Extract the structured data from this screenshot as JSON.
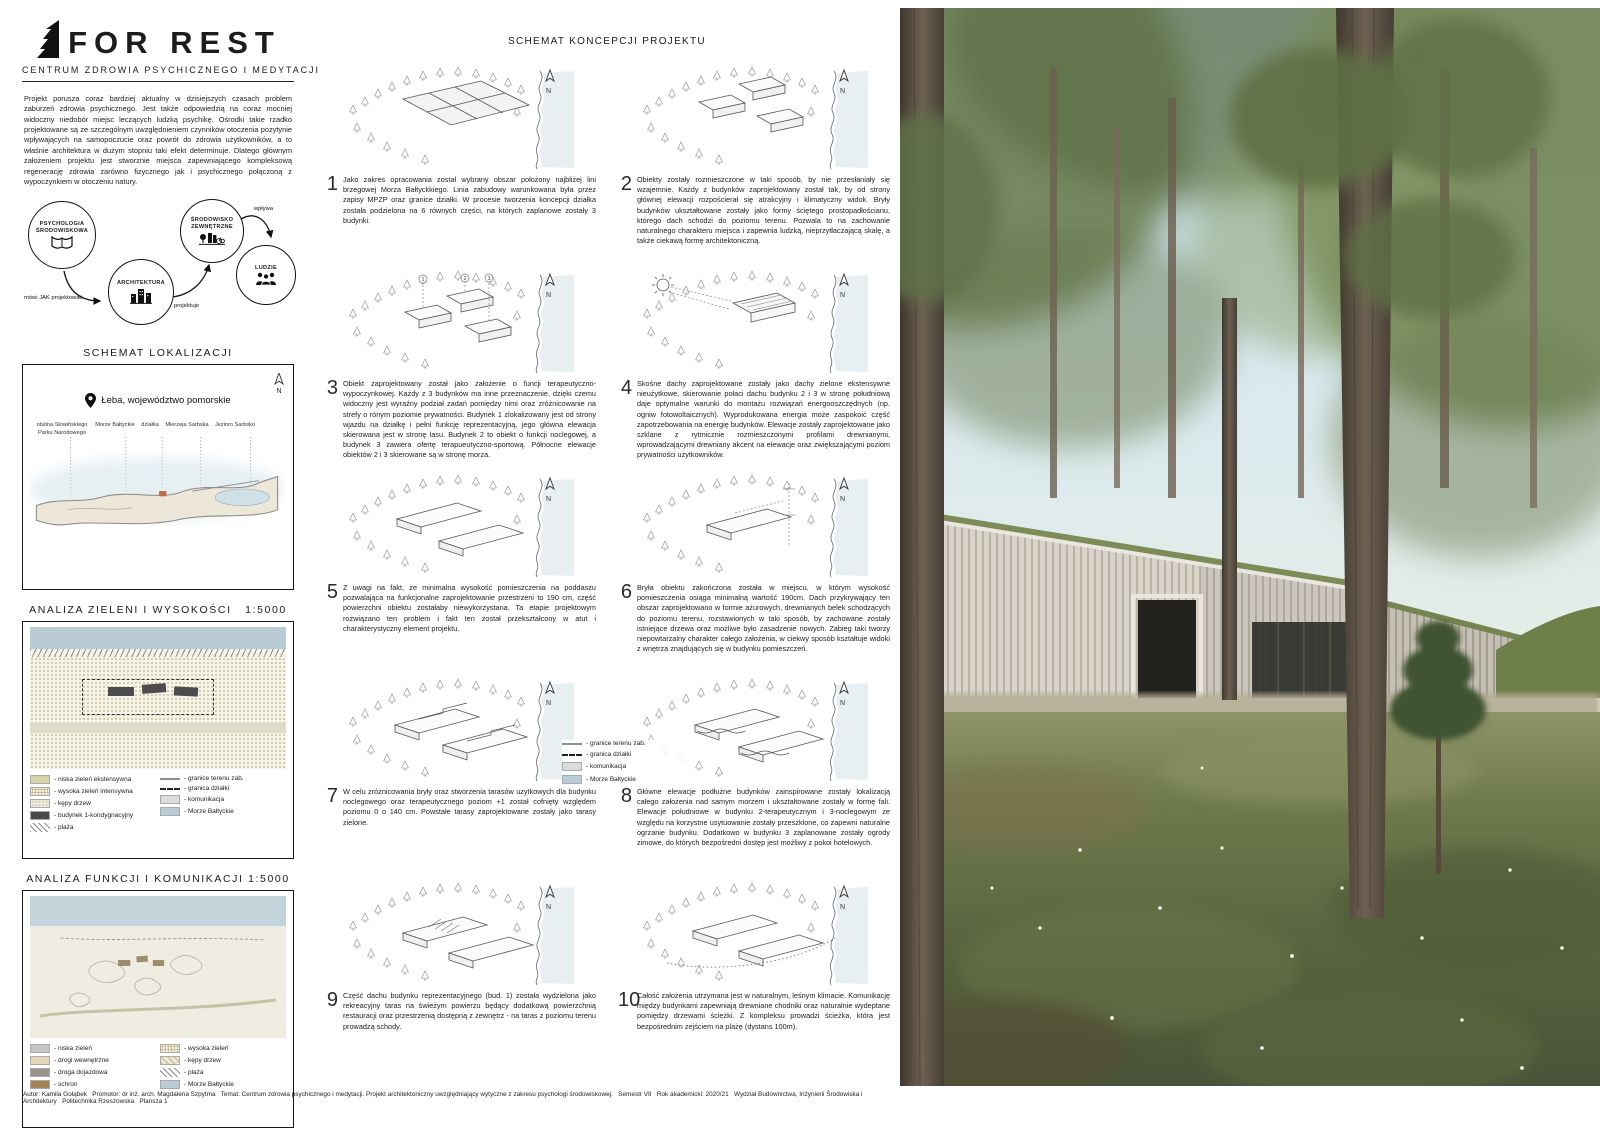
{
  "north": "N",
  "header": {
    "title": "FOR REST",
    "subtitle": "CENTRUM ZDROWIA PSYCHICZNEGO I MEDYTACJI"
  },
  "intro": "Projekt porusza coraz bardziej aktualny w dzisiejszych czasach problem zaburzeń zdrowia psychicznego. Jest także odpowiedzią na coraz mocniej widoczny niedobór miejsc leczących ludzką psychikę. Ośrodki takie rzadko projektowane są ze szczególnym uwzględnieniem czynników otoczenia pozytynie wpływających na samopoczucie oraz powrót do zdrowia użytkowników, a to właśnie architektura w dużym stopniu taki efekt determinuje. Dlatego głównym założeniem projektu jest stworznie miejsca zapewniającego kompleksową regenerację zdrowia zarówno fizycznego jak i psychicznego połączoną z wypoczynkiem w otoczeniu natury.",
  "flow": {
    "circle1": "PSYCHOLOGIA ŚRODOWISKOWA",
    "circle2": "ARCHITEKTURA",
    "circle3": "ŚRODOWISKO ZEWNĘTRZNE",
    "circle4": "LUDZIE",
    "arrow1": "mówi JAK projektować",
    "arrow2": "projektuje",
    "arrow3": "wpływa"
  },
  "localization": {
    "title": "SCHEMAT LOKALIZACJI",
    "place": "Łeba, województwo pomorskie",
    "labels": [
      "otulina Słowińskiego Parku Narodowego",
      "Morze Bałtyckie",
      "działka",
      "Mierzeja Sarbska",
      "Jezioro Sarbsko"
    ]
  },
  "analysis_green": {
    "title": "ANALIZA ZIELENI I WYSOKOŚCI   1:5000",
    "legend": [
      "- niska zieleń ekstensywna",
      "- wysoka zieleń intensywna",
      "- kępy drzew",
      "- budynek 1-kondygnacyjny",
      "- plaża",
      "- granice terenu zab.",
      "- granica działki",
      "- komunikacja",
      "- Morze Bałtyckie"
    ]
  },
  "analysis_function": {
    "title": "ANALIZA FUNKCJI I KOMUNIKACJI 1:5000",
    "legend": [
      "- niska zieleń",
      "- drogi wewnętrzne",
      "- droga dojazdowa",
      "- schron",
      "- wysoka zieleń",
      "- kępy drzew",
      "- plaża",
      "- Morze Bałtyckie"
    ]
  },
  "concept": {
    "title": "SCHEMAT KONCEPCJI PROJEKTU",
    "legend": [
      "- granice terenu zab.",
      "- granica działki",
      "- komunikacja",
      "- Morze Bałtyckie"
    ],
    "markers": [
      "1",
      "2",
      "3"
    ],
    "items": [
      {
        "num": "1",
        "text": "Jako zakres opracowania został wybrany obszar położony najbliżej lini brzegowej Morza Bałtyckkiego. Linia zabudowy warunkowana była przez zapisy MPZP oraz granice działki. W procesie tworzenia koncepcji działka została podzielona na 6 równych części, na których zaplanowe zostały 3 budynki."
      },
      {
        "num": "2",
        "text": "Obiekty zostały rozmieszczone w taki sposób, by nie przesłaniały się wzajemnie. Każdy z budynków zaprojektowany został tak, by od strony głównej elewacji rozpościerał się atrakcyjny i klimatyczny widok. Bryły budynków ukształtowane zostały jako formy ściętego prostopadłościanu, którego dach schodzi do poziomu terenu. Pozwala to na zachowanie naturalnego charakteru miejsca i zapewnia ludzką, nieprzytłaczającą skalę, a także ciekawą formę architektoniczną."
      },
      {
        "num": "3",
        "text": "Obiekt zaprojektowany został jako założenie o funcji terapeutyczno-wypoczynkowej. Każdy z 3 budynków ma inne przeznaczenie, dzięki czemu widoczny jest wyraźny podział zadań pomiędzy nimi oraz zróżnicowanie na strefy o rónym poziomie prywatności. Budynek 1 zlokalizowany jest od strony wjazdu na działkę i pełni funkcję reprezentacyjną, jego główna elewacja skierowana jest w stronę lasu. Budynek 2 to obiekt o funkcji noclegowej, a budynek 3 zawiera ofertę terapueutyczno-sportową. Północne elewacje obiektów 2 i 3 skierowane są w stronę morza."
      },
      {
        "num": "4",
        "text": "Skośne dachy zaprojektowane zostały jako dachy zielone ekstensywne nieużytkowe, skierowanie połaci dachu budynku 2 i 3 w stronę południową daje optymalne warunki do montażu rozwiązań energooszczędnych (np. ogniw fotowoltaicznych). Wyprodukowana energia może zaspokoić część zapotrzebowania na energię budynków. Elewacje zostały zaprojektowane jako szklane z rytmicznie rozmieszczonymi profilami drewnianymi, wprowadzającymi drewniany akcent na elewacje oraz zwiększającymi poziom prywatności użytkowników."
      },
      {
        "num": "5",
        "text": "Z uwagi na fakt, że minimalna wysokość pomieszczenia na poddaszu pozwalająca na funkcjonalne zaprojektowanie przestrzeni to 190 cm, część powierzchni obiektu zostałaby niewykorzystana. Ta etapie projektowym rozwiązano ten problem i fakt ten został przekształcony w atut i charakterystyczny element projektu."
      },
      {
        "num": "6",
        "text": "Bryła obiektu zakończona została w miejscu, w którym wysokość pomieszczenia osiąga minimalną wartość 190cm. Dach przykrywający ten obszar zaprojektowano w formie ażurowych, drewnianych belek schodzących do poziomu terenu, rozstawionych w taki sposób, by zachowane zostały istniejące drzewa oraz możliwe było zasadzenie nowych. Zabieg taki tworzy niepowtarzalny charakter całego założenia, w ciekwy sposób kształtuje widoki z wnętrza znajdujących się w budynku pomieszczeń."
      },
      {
        "num": "7",
        "text": "W celu zróżnicowania bryły oraz stworzenia tarasów uzytkowych dla budynku noclegowego oraz terapeutycznego poziom +1 został cofnięty względem poziomu 0 o 140 cm. Powstałe tarasy zaprojektowane zostały jako tarasy zielone."
      },
      {
        "num": "8",
        "text": "Główne elewacje podłużne budynków zainspirowane zostały lokalizacją całego założenia nad samym morzem i ukształtowane zostały w formę fali. Elewacje południowe w budynku 2-terapeutycznym i 3-noclegowym ze względu na korzystne usytuowanie zostały przeszklone, co zapewni naturalne ogrzanie budynku. Dodatkowo w budynku 3 zaplanowane zostały ogrody zimowe, do których bezpośredni dostęp jest możliwy z pokoi hotelowych."
      },
      {
        "num": "9",
        "text": "Część dachu budynku reprezentacyjnego (bud. 1) została wydzielona jako rekreacyjny taras na świeżym powierzu będący dodatkową powierzchnią restauracji oraz przestrzenią dostępną z zewnętrz - na taras z poziomu terenu prowadzą schody."
      },
      {
        "num": "10",
        "text": "Całość założenia utrzymana jest w naturalnym, leśnym klimacie. Komunikację między budynkami zapewniają drewniane chodniki oraz naturalnie wydeptane pomiędzy drzewami ścieżki. Z kompleksu prowadzi ścieżka, która jest bezpośrednim zejściem na plażę (dystans 100m)."
      }
    ]
  },
  "footer": "Autor: Kamila Gołąbek   Promotor: dr inż. arch. Magdalena Szpytma   Temat: Centrum zdrowia psychicznego i medytacji. Projekt architektoniczny uwzględniający wytyczne z zakresu psychologi środowiskowej.   Semestr VII   Rok akademicki: 2020/21   Wydział Budownictwa, Inżynierii Środowiska i Architektury   Politechnika Rzeszowska   Plansza 1",
  "colors": {
    "sea": "#b9ccd5",
    "roof_green": "#7d8b57",
    "wood_facade": "#d8d4ca",
    "sky": "#cfe3ec",
    "moss": "#5c663f"
  }
}
